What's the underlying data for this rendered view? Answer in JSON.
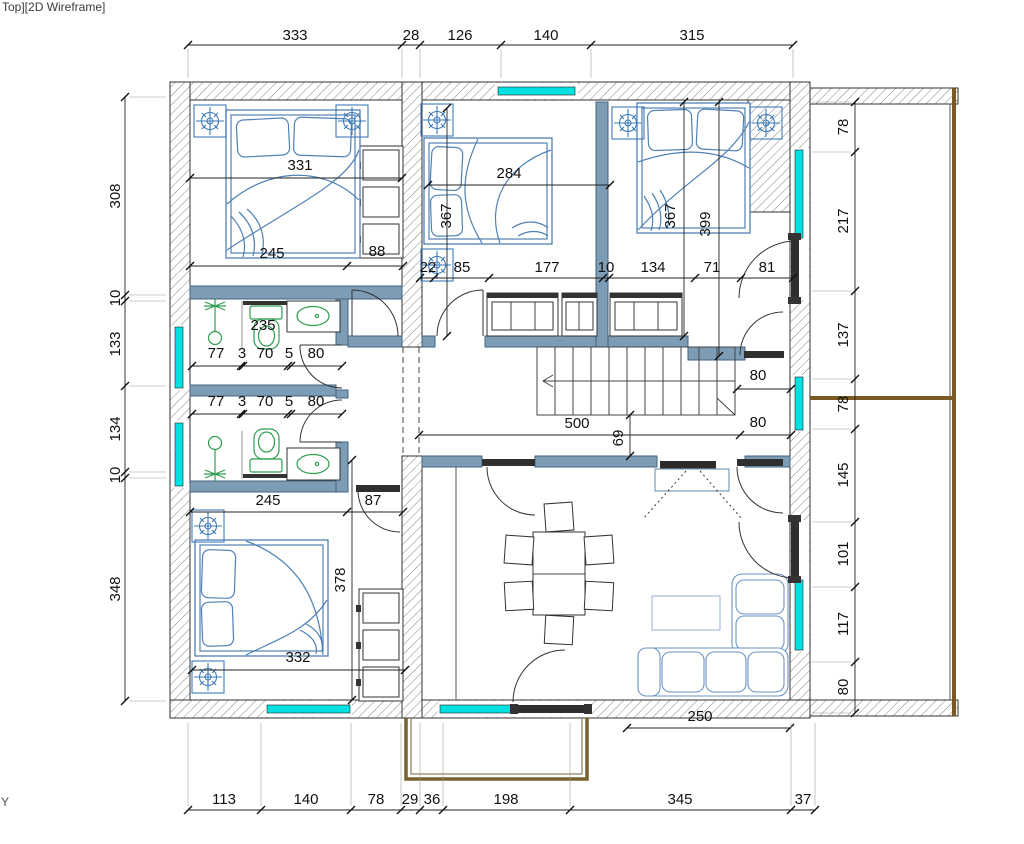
{
  "viewport": {
    "label": "Top][2D Wireframe]",
    "axis_label": "Y"
  },
  "colors": {
    "accent_cyan": "#00e0e0",
    "wall_blue": "#7d9cb6",
    "wall_blue_dark": "#43637f",
    "furniture_blue": "#4f81b5",
    "fixture_green": "#2e9e4f",
    "wood_brown": "#77622f",
    "dim_text": "#111111"
  },
  "dimensions": {
    "top_row": [
      {
        "v": "333",
        "x": 295,
        "y": 40
      },
      {
        "v": "28",
        "x": 411,
        "y": 40
      },
      {
        "v": "126",
        "x": 460,
        "y": 40
      },
      {
        "v": "140",
        "x": 546,
        "y": 40
      },
      {
        "v": "315",
        "x": 692,
        "y": 40
      }
    ],
    "bottom_row": [
      {
        "v": "113",
        "x": 224,
        "y": 804
      },
      {
        "v": "140",
        "x": 306,
        "y": 804
      },
      {
        "v": "78",
        "x": 376,
        "y": 804
      },
      {
        "v": "29",
        "x": 410,
        "y": 804
      },
      {
        "v": "36",
        "x": 432,
        "y": 804
      },
      {
        "v": "198",
        "x": 506,
        "y": 804
      },
      {
        "v": "345",
        "x": 680,
        "y": 804
      },
      {
        "v": "37",
        "x": 803,
        "y": 804
      }
    ],
    "left_column": [
      {
        "v": "308",
        "x": 120,
        "y": 196,
        "r": -90
      },
      {
        "v": "10",
        "x": 120,
        "y": 298,
        "r": -90
      },
      {
        "v": "133",
        "x": 120,
        "y": 344,
        "r": -90
      },
      {
        "v": "134",
        "x": 120,
        "y": 429,
        "r": -90
      },
      {
        "v": "10",
        "x": 120,
        "y": 475,
        "r": -90
      },
      {
        "v": "348",
        "x": 120,
        "y": 589,
        "r": -90
      }
    ],
    "right_column": [
      {
        "v": "78",
        "x": 848,
        "y": 127,
        "r": -90
      },
      {
        "v": "217",
        "x": 848,
        "y": 221,
        "r": -90
      },
      {
        "v": "137",
        "x": 848,
        "y": 335,
        "r": -90
      },
      {
        "v": "78",
        "x": 848,
        "y": 404,
        "r": -90
      },
      {
        "v": "145",
        "x": 848,
        "y": 475,
        "r": -90
      },
      {
        "v": "101",
        "x": 848,
        "y": 554,
        "r": -90
      },
      {
        "v": "117",
        "x": 848,
        "y": 624,
        "r": -90
      },
      {
        "v": "80",
        "x": 848,
        "y": 687,
        "r": -90
      }
    ],
    "interior": [
      {
        "v": "331",
        "x": 300,
        "y": 170
      },
      {
        "v": "245",
        "x": 272,
        "y": 258
      },
      {
        "v": "88",
        "x": 377,
        "y": 256
      },
      {
        "v": "22",
        "x": 428,
        "y": 272
      },
      {
        "v": "85",
        "x": 462,
        "y": 272
      },
      {
        "v": "177",
        "x": 547,
        "y": 272
      },
      {
        "v": "10",
        "x": 606,
        "y": 272
      },
      {
        "v": "134",
        "x": 653,
        "y": 272
      },
      {
        "v": "71",
        "x": 712,
        "y": 272
      },
      {
        "v": "81",
        "x": 767,
        "y": 272
      },
      {
        "v": "284",
        "x": 509,
        "y": 178
      },
      {
        "v": "367",
        "x": 451,
        "y": 216,
        "r": -90
      },
      {
        "v": "367",
        "x": 675,
        "y": 216,
        "r": -90
      },
      {
        "v": "399",
        "x": 710,
        "y": 224,
        "r": -90
      },
      {
        "v": "77",
        "x": 216,
        "y": 358
      },
      {
        "v": "3",
        "x": 242,
        "y": 358
      },
      {
        "v": "70",
        "x": 265,
        "y": 358
      },
      {
        "v": "5",
        "x": 289,
        "y": 358
      },
      {
        "v": "80",
        "x": 316,
        "y": 358
      },
      {
        "v": "77",
        "x": 216,
        "y": 406
      },
      {
        "v": "3",
        "x": 242,
        "y": 406
      },
      {
        "v": "70",
        "x": 265,
        "y": 406
      },
      {
        "v": "5",
        "x": 289,
        "y": 406
      },
      {
        "v": "80",
        "x": 316,
        "y": 406
      },
      {
        "v": "500",
        "x": 577,
        "y": 428
      },
      {
        "v": "69",
        "x": 623,
        "y": 438,
        "r": -90
      },
      {
        "v": "80",
        "x": 758,
        "y": 380
      },
      {
        "v": "80",
        "x": 758,
        "y": 427
      },
      {
        "v": "245",
        "x": 268,
        "y": 505
      },
      {
        "v": "87",
        "x": 373,
        "y": 505
      },
      {
        "v": "378",
        "x": 345,
        "y": 580,
        "r": -90
      },
      {
        "v": "332",
        "x": 298,
        "y": 662
      },
      {
        "v": "250",
        "x": 700,
        "y": 721
      }
    ],
    "annotations": [
      {
        "v": "235",
        "x": 263,
        "y": 330,
        "c": "#00bccc"
      }
    ]
  }
}
